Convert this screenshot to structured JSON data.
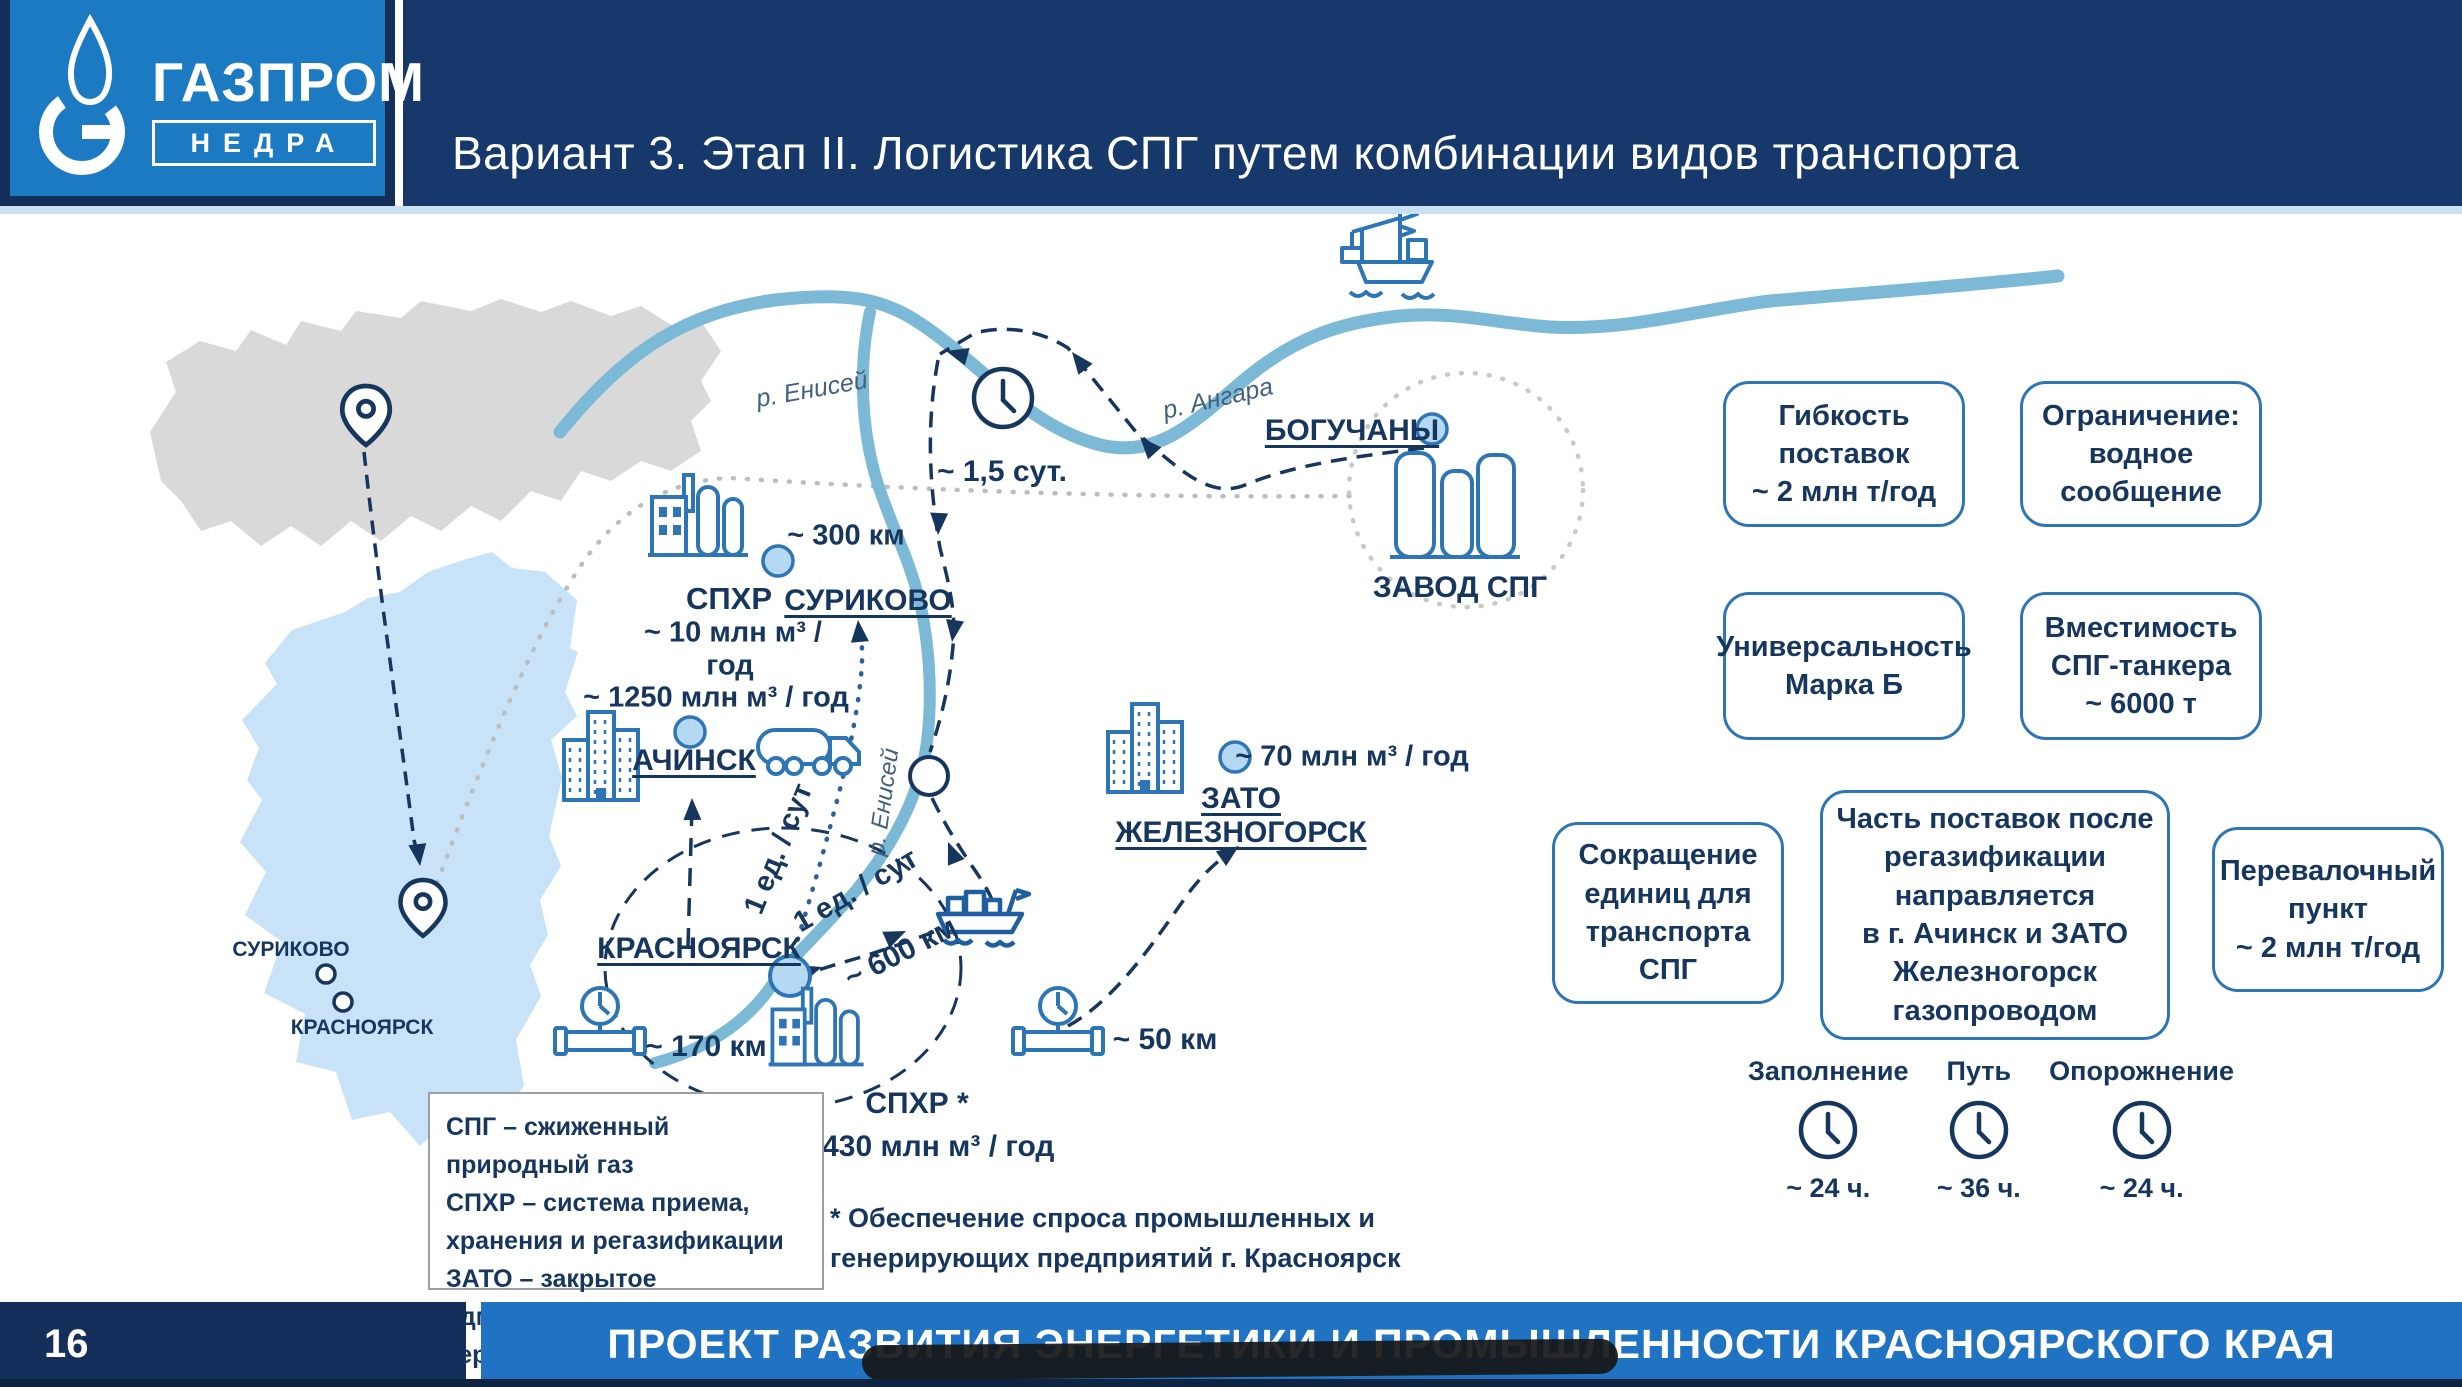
{
  "header": {
    "brand_line1": "ГАЗПРОМ",
    "brand_line2": "НЕДРА",
    "title": "Вариант 3. Этап II. Логистика СПГ путем комбинации видов транспорта"
  },
  "map": {
    "rivers": {
      "enisey_top": "р. Енисей",
      "angara": "р. Ангара",
      "enisey_side": "р. Енисей"
    },
    "transit_time": "~ 1,5 сут.",
    "boguchany": "БОГУЧАНЫ",
    "lng_plant": "ЗАВОД СПГ",
    "spxr_north_title": "СПХР",
    "spxr_north_cap1": "~ 10 млн м³ /",
    "spxr_north_cap2": "год",
    "dist_300": "~ 300 км",
    "surikovo": "СУРИКОВО",
    "achinsk_cap": "~ 1250 млн м³ / год",
    "achinsk": "АЧИНСК",
    "zato_cap": "~ 70 млн м³ / год",
    "zato_line1": "ЗАТО",
    "zato_line2": "ЖЕЛЕЗНОГОРСК",
    "krasnoyarsk": "КРАСНОЯРСК",
    "dist_600": "~ 600 км",
    "unit_rate1": "1 ед. / сут",
    "unit_rate2": "1 ед. / сут",
    "dist_170": "~ 170 км",
    "dist_50": "~ 50 км",
    "spxr_south_title": "СПХР *",
    "spxr_south_cap": "~ 1430 млн м³ / год",
    "minimap_surikovo": "СУРИКОВО",
    "minimap_krasnoyarsk": "КРАСНОЯРСК"
  },
  "info_boxes": {
    "flexibility": "Гибкость\nпоставок\n~ 2 млн т/год",
    "limitation": "Ограничение:\nводное\nсообщение",
    "universality": "Универсальность\nМарка Б",
    "tanker": "Вместимость\nСПГ-танкера\n~ 6000 т",
    "reduction": "Сокращение\nединиц для\nтранспорта СПГ",
    "regas": "Часть поставок после\nрегазификации\nнаправляется\nв г. Ачинск и ЗАТО\nЖелезногорск\nгазопроводом",
    "transshipment": "Перевалочный\nпункт\n~ 2 млн т/год"
  },
  "clocks": {
    "filling": {
      "label": "Заполнение",
      "value": "~ 24 ч."
    },
    "route": {
      "label": "Путь",
      "value": "~ 36 ч."
    },
    "emptying": {
      "label": "Опорожнение",
      "value": "~ 24 ч."
    }
  },
  "legend": {
    "lines": [
      "СПГ – сжиженный природный газ",
      "СПХР – система приема,",
      "хранения и регазификации",
      "ЗАТО – закрытое административно-",
      "территориальное образование"
    ]
  },
  "footnote": {
    "lines": [
      "* Обеспечение спроса промышленных и",
      "генерирующих предприятий г. Красноярск"
    ]
  },
  "footer": {
    "page": "16",
    "title": "ПРОЕКТ РАЗВИТИЯ ЭНЕРГЕТИКИ И ПРОМЫШЛЕННОСТИ КРАСНОЯРСКОГО КРАЯ"
  },
  "colors": {
    "navy": "#17386b",
    "logo_blue": "#1c7ac2",
    "footer_blue": "#2072c2",
    "river": "#7cb9d7",
    "region": "#c8e2f8",
    "icon_stroke": "#2e75b6",
    "text_navy": "#17365d"
  }
}
